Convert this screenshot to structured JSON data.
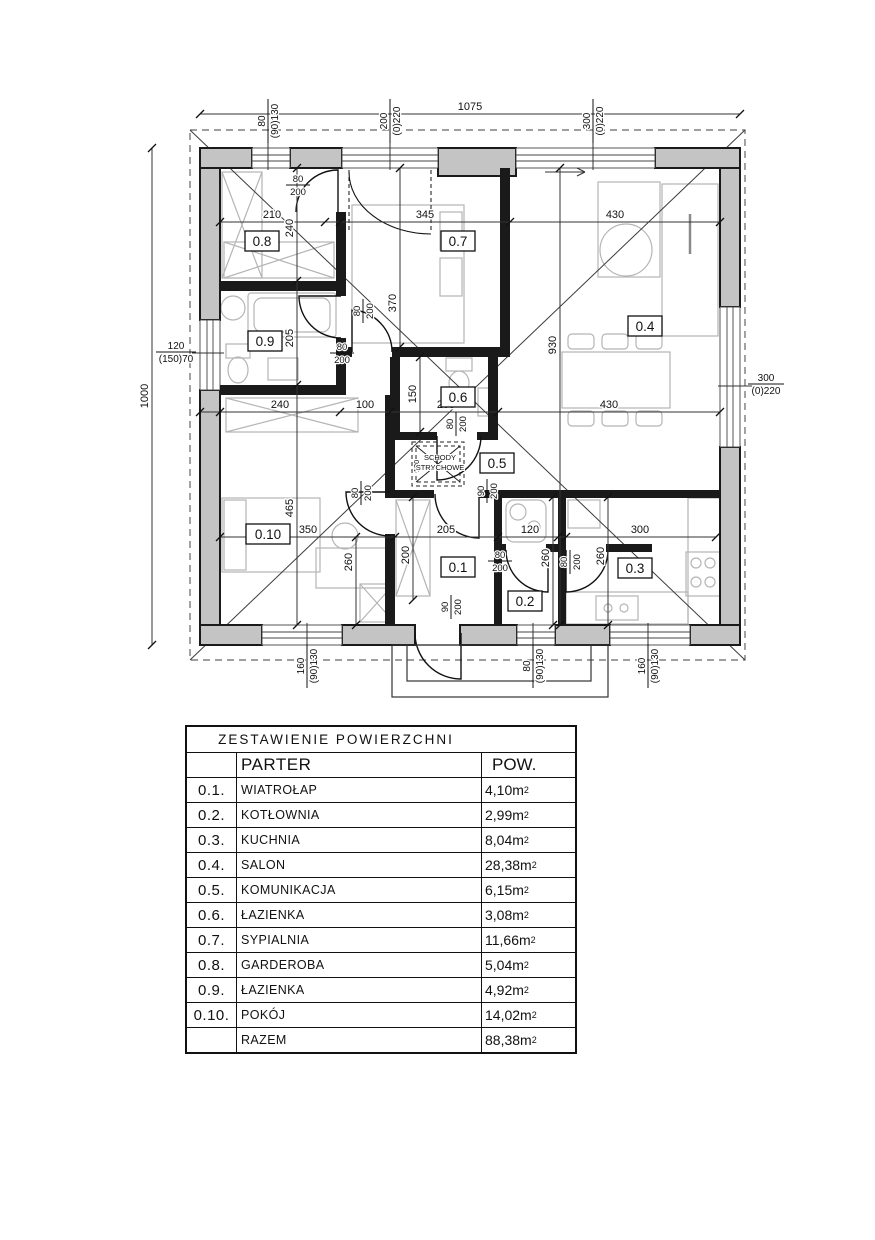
{
  "plan": {
    "rooms": {
      "r1": "0.1",
      "r2": "0.2",
      "r3": "0.3",
      "r4": "0.4",
      "r5": "0.5",
      "r6": "0.6",
      "r7": "0.7",
      "r8": "0.8",
      "r9": "0.9",
      "r10": "0.10"
    },
    "dims": {
      "overall_w": "1075",
      "overall_h": "1000",
      "t1": "210",
      "t2": "345",
      "t3": "430",
      "v1": "240",
      "v2": "370",
      "m1": "240",
      "m2": "100",
      "m3": "205",
      "m4": "430",
      "v3": "205",
      "v4": "150",
      "v5": "930",
      "b1": "350",
      "b2": "205",
      "b3": "120",
      "b4": "300",
      "v6": "465",
      "v7": "260",
      "v8": "200",
      "v9": "260",
      "v10": "260"
    },
    "windows": {
      "tl": {
        "w": "80",
        "h": "(90)130"
      },
      "tm": {
        "w": "200",
        "h": "(0)220"
      },
      "tr": {
        "w": "300",
        "h": "(0)220"
      },
      "l": {
        "w": "120",
        "h": "(150)70"
      },
      "r": {
        "w": "300",
        "h": "(0)220"
      },
      "bl": {
        "w": "160",
        "h": "(90)130"
      },
      "bm": {
        "w": "80",
        "h": "(90)130"
      },
      "br": {
        "w": "160",
        "h": "(90)130"
      }
    },
    "doors": {
      "d08": {
        "w": "80",
        "h": "200"
      },
      "d07": {
        "w": "80",
        "h": "200"
      },
      "d09": {
        "w": "80",
        "h": "200"
      },
      "d06": {
        "w": "80",
        "h": "200"
      },
      "d010": {
        "w": "80",
        "h": "200"
      },
      "d01": {
        "w": "90",
        "h": "200"
      },
      "d02": {
        "w": "80",
        "h": "200"
      },
      "d03": {
        "w": "80",
        "h": "200"
      },
      "entry": {
        "w": "90",
        "h": "200"
      }
    },
    "attic_stairs": {
      "line1": "SCHODY",
      "line2": "STRYCHOWE",
      "size": "130"
    }
  },
  "table": {
    "title": "ZESTAWIENIE  POWIERZCHNI",
    "header": {
      "parter": "PARTER",
      "pow": "POW."
    },
    "unit": "m",
    "sup": "2",
    "rows": [
      {
        "id": "0.1.",
        "name": "WIATROŁAP",
        "area": "4,10"
      },
      {
        "id": "0.2.",
        "name": "KOTŁOWNIA",
        "area": "2,99"
      },
      {
        "id": "0.3.",
        "name": "KUCHNIA",
        "area": "8,04"
      },
      {
        "id": "0.4.",
        "name": "SALON",
        "area": "28,38"
      },
      {
        "id": "0.5.",
        "name": "KOMUNIKACJA",
        "area": "6,15"
      },
      {
        "id": "0.6.",
        "name": "ŁAZIENKA",
        "area": "3,08"
      },
      {
        "id": "0.7.",
        "name": "SYPIALNIA",
        "area": "11,66"
      },
      {
        "id": "0.8.",
        "name": "GARDEROBA",
        "area": "5,04"
      },
      {
        "id": "0.9.",
        "name": "ŁAZIENKA",
        "area": "4,92"
      },
      {
        "id": "0.10.",
        "name": "POKÓJ",
        "area": "14,02"
      }
    ],
    "razem": {
      "label": "RAZEM",
      "area": "88,38"
    }
  }
}
